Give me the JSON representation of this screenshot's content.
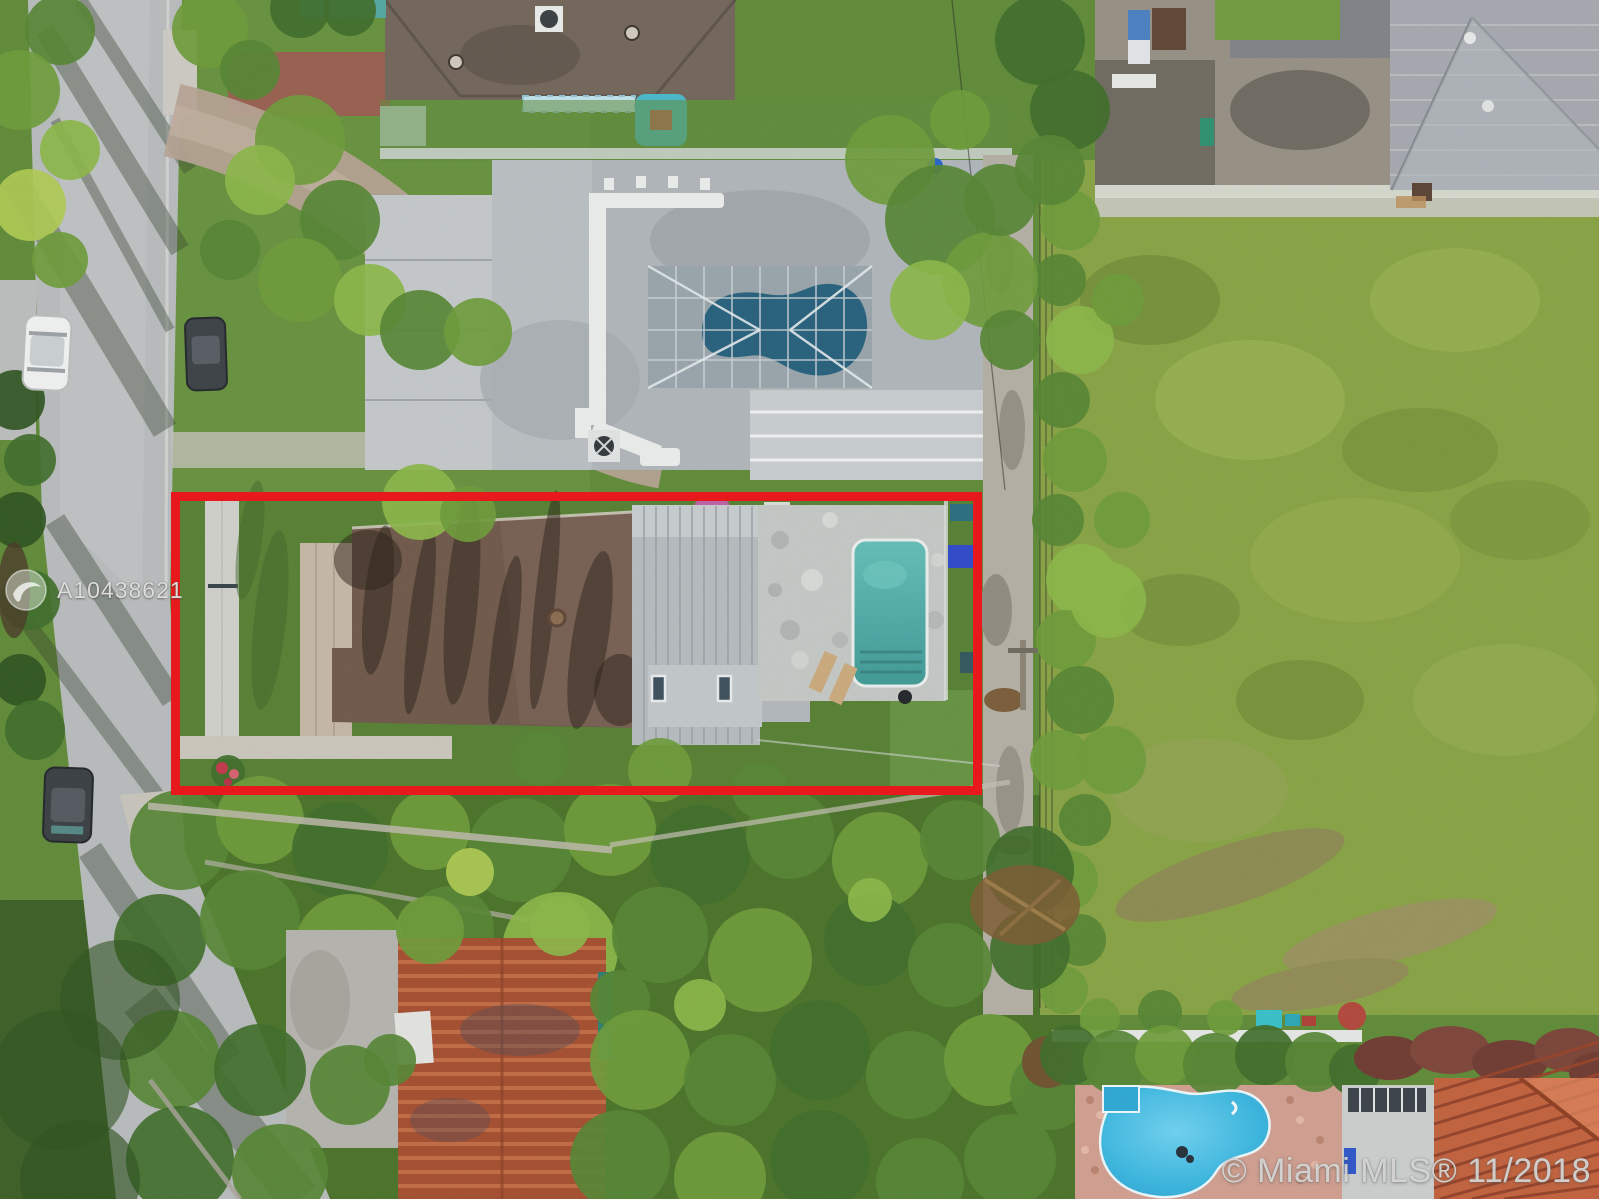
{
  "watermarks": {
    "mls_id": "A10438621",
    "copyright": "© Miami MLS® 11/2018",
    "logo_icon": "circle-swoosh-mls-logo"
  },
  "annotation": {
    "name": "property-boundary-highlight",
    "style": "border-color:#e8191c"
  },
  "palette": {
    "highlight_red": "#e8191c",
    "road_gray": "#b7babb",
    "field_green": "#87a144",
    "jungle_green": "#4a7229",
    "subject_roof_brown": "#6e584a",
    "neighbor_roof_gray": "#aeb4b8",
    "subject_pool_teal": "#4fa8a4",
    "bottom_pool_blue": "#3ab5de",
    "tile_roof_terracotta": "#c0613d"
  }
}
